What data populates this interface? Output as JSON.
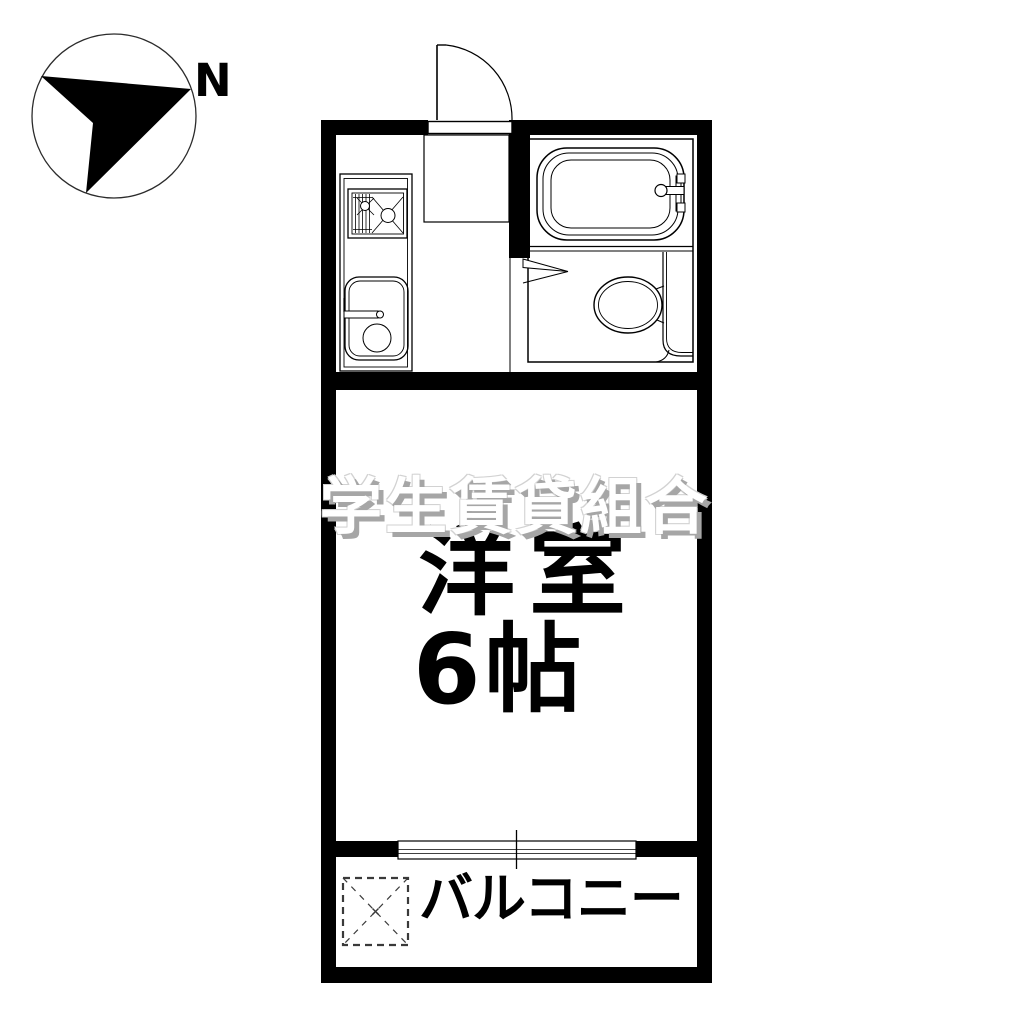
{
  "compass": {
    "north_label": "N"
  },
  "rooms": {
    "main_room": {
      "name": "洋室",
      "size": "6帖"
    },
    "balcony": {
      "name": "バルコニー"
    }
  },
  "watermark": {
    "text": "学生賃貸組合"
  },
  "fixtures": {
    "compass_icon": "compass-north-arrow",
    "entrance_door_icon": "entrance-swing-door",
    "genkan_icon": "entry-step",
    "stove_icon": "gas-stove",
    "sink_icon": "kitchen-sink",
    "bathtub_icon": "bathtub",
    "faucet_icon": "bath-faucet",
    "toilet_icon": "toilet",
    "bath_door_icon": "door-swing-marker",
    "window_icon": "balcony-sliding-window",
    "washer_icon": "washing-machine-space"
  },
  "colors": {
    "background": "#ffffff",
    "wall": "#000000",
    "line": "#000000",
    "watermark-fill": "#ffffff",
    "watermark-shadow": "#a6a6a6",
    "text": "#000000"
  }
}
